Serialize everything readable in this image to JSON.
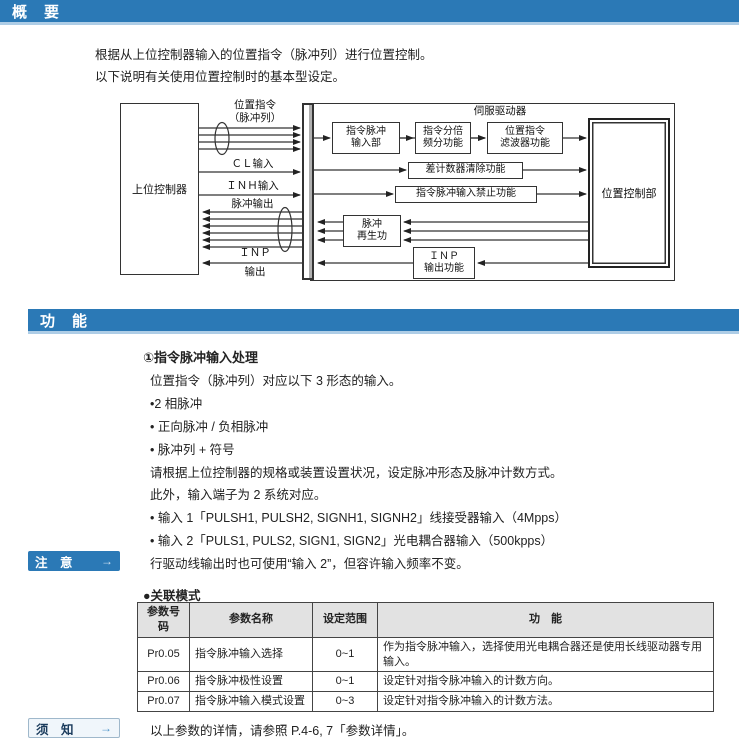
{
  "colors": {
    "accent_blue": "#2b79b6",
    "bar_underline": "#aecde6",
    "table_header_bg": "#e2e2e2"
  },
  "overview": {
    "header": "概　要",
    "line1": "根据从上位控制器输入的位置指令（脉冲列）进行位置控制。",
    "line2": "以下说明有关使用位置控制时的基本型设定。"
  },
  "diagram": {
    "host_box": "上位控制器",
    "servo_label": "伺服驱动器",
    "pos_control_box": "位置控制部",
    "boxes": {
      "pulse_input": "指令脉冲\n输入部",
      "freq_divider": "指令分倍\n频分功能",
      "cmd_filter": "位置指令\n滤波器功能",
      "counter_clear": "差计数器清除功能",
      "input_inhibit": "指令脉冲输入禁止功能",
      "pulse_regen": "脉冲\n再生功",
      "inp_output": "ＩＮＰ\n输出功能"
    },
    "labels": {
      "pos_cmd": "位置指令\n（脉冲列）",
      "cl_input": "ＣＬ输入",
      "inh_input": "ＩＮＨ输入",
      "pulse_out": "脉冲输出",
      "inp_top": "ＩＮＰ",
      "inp_bottom": "输出"
    }
  },
  "function": {
    "header": "功　能",
    "title": "①指令脉冲输入处理",
    "lines": [
      "位置指令（脉冲列）对应以下 3 形态的输入。",
      "•2 相脉冲",
      "• 正向脉冲 / 负相脉冲",
      "• 脉冲列 + 符号",
      "请根据上位控制器的规格或装置设置状况，设定脉冲形态及脉冲计数方式。",
      "此外，输入端子为 2 系统对应。",
      "• 输入 1「PULSH1, PULSH2, SIGNH1, SIGNH2」线接受器输入（4Mpps）",
      "• 输入 2「PULS1, PULS2, SIGN1, SIGN2」光电耦合器输入（500kpps）"
    ]
  },
  "note": {
    "badge": "注　意",
    "arrow": "→",
    "text": "行驱动线输出时也可使用“输入 2”，但容许输入频率不变。"
  },
  "related": {
    "title": "●关联模式"
  },
  "table": {
    "headers": [
      "参数号码",
      "参数名称",
      "设定范围",
      "功　能"
    ],
    "rows": [
      {
        "code": "Pr0.05",
        "name": "指令脉冲输入选择",
        "range": "0~1",
        "func": "作为指令脉冲输入，选择使用光电耦合器还是使用长线驱动器专用输入。"
      },
      {
        "code": "Pr0.06",
        "name": "指令脉冲极性设置",
        "range": "0~1",
        "func": "设定针对指令脉冲输入的计数方向。"
      },
      {
        "code": "Pr0.07",
        "name": "指令脉冲输入模式设置",
        "range": "0~3",
        "func": "设定针对指令脉冲输入的计数方法。"
      }
    ]
  },
  "notice": {
    "badge": "须　知",
    "arrow": "→",
    "text": "以上参数的详情，请参照 P.4-6, 7「参数详情」。"
  }
}
